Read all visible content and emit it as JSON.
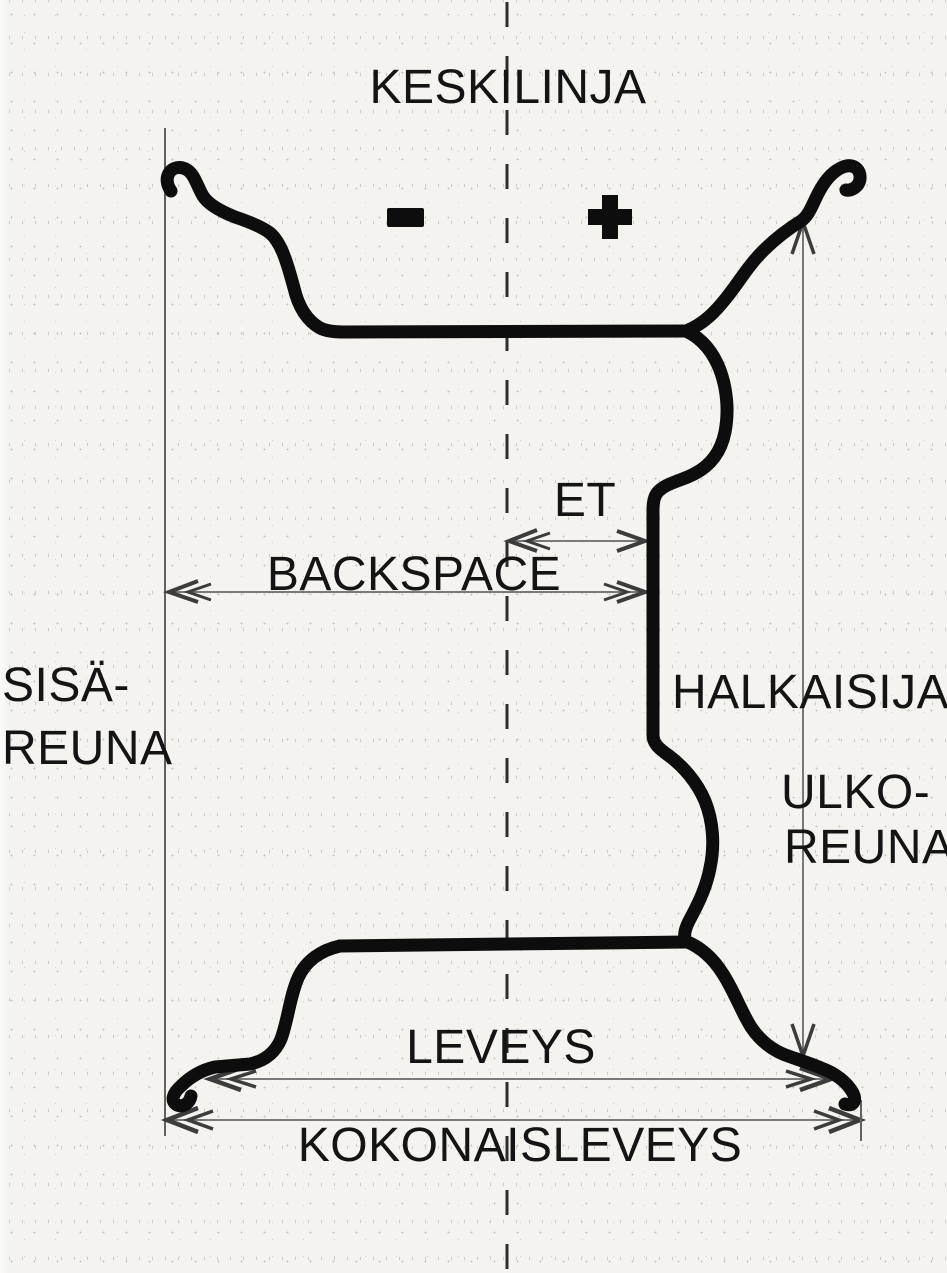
{
  "diagram": {
    "subject": "wheel-rim-cross-section",
    "labels": {
      "keskilinja": "KESKILINJA",
      "et": "ET",
      "backspace": "BACKSPACE",
      "sisa_line1": "SISÄ-",
      "sisa_line2": "REUNA",
      "halkaisija": "HALKAISIJA",
      "ulko_line1": "ULKO-",
      "ulko_line2": "REUNA",
      "leveys": "LEVEYS",
      "kokonaisleveys": "KOKONAISLEVEYS"
    },
    "symbols": {
      "minus": "-",
      "plus": "+"
    },
    "icons": {
      "minus-icon": "heavy minus sign left of centerline",
      "plus-icon": "heavy plus sign right of centerline"
    },
    "colors": {
      "paper": "#f4f3f0",
      "ink": "#0d0d0d",
      "thin_line": "#606060",
      "arrow_line": "#7a7a7a",
      "arrow_head": "#3c3c3c",
      "centerline": "#2d2d2d"
    }
  }
}
